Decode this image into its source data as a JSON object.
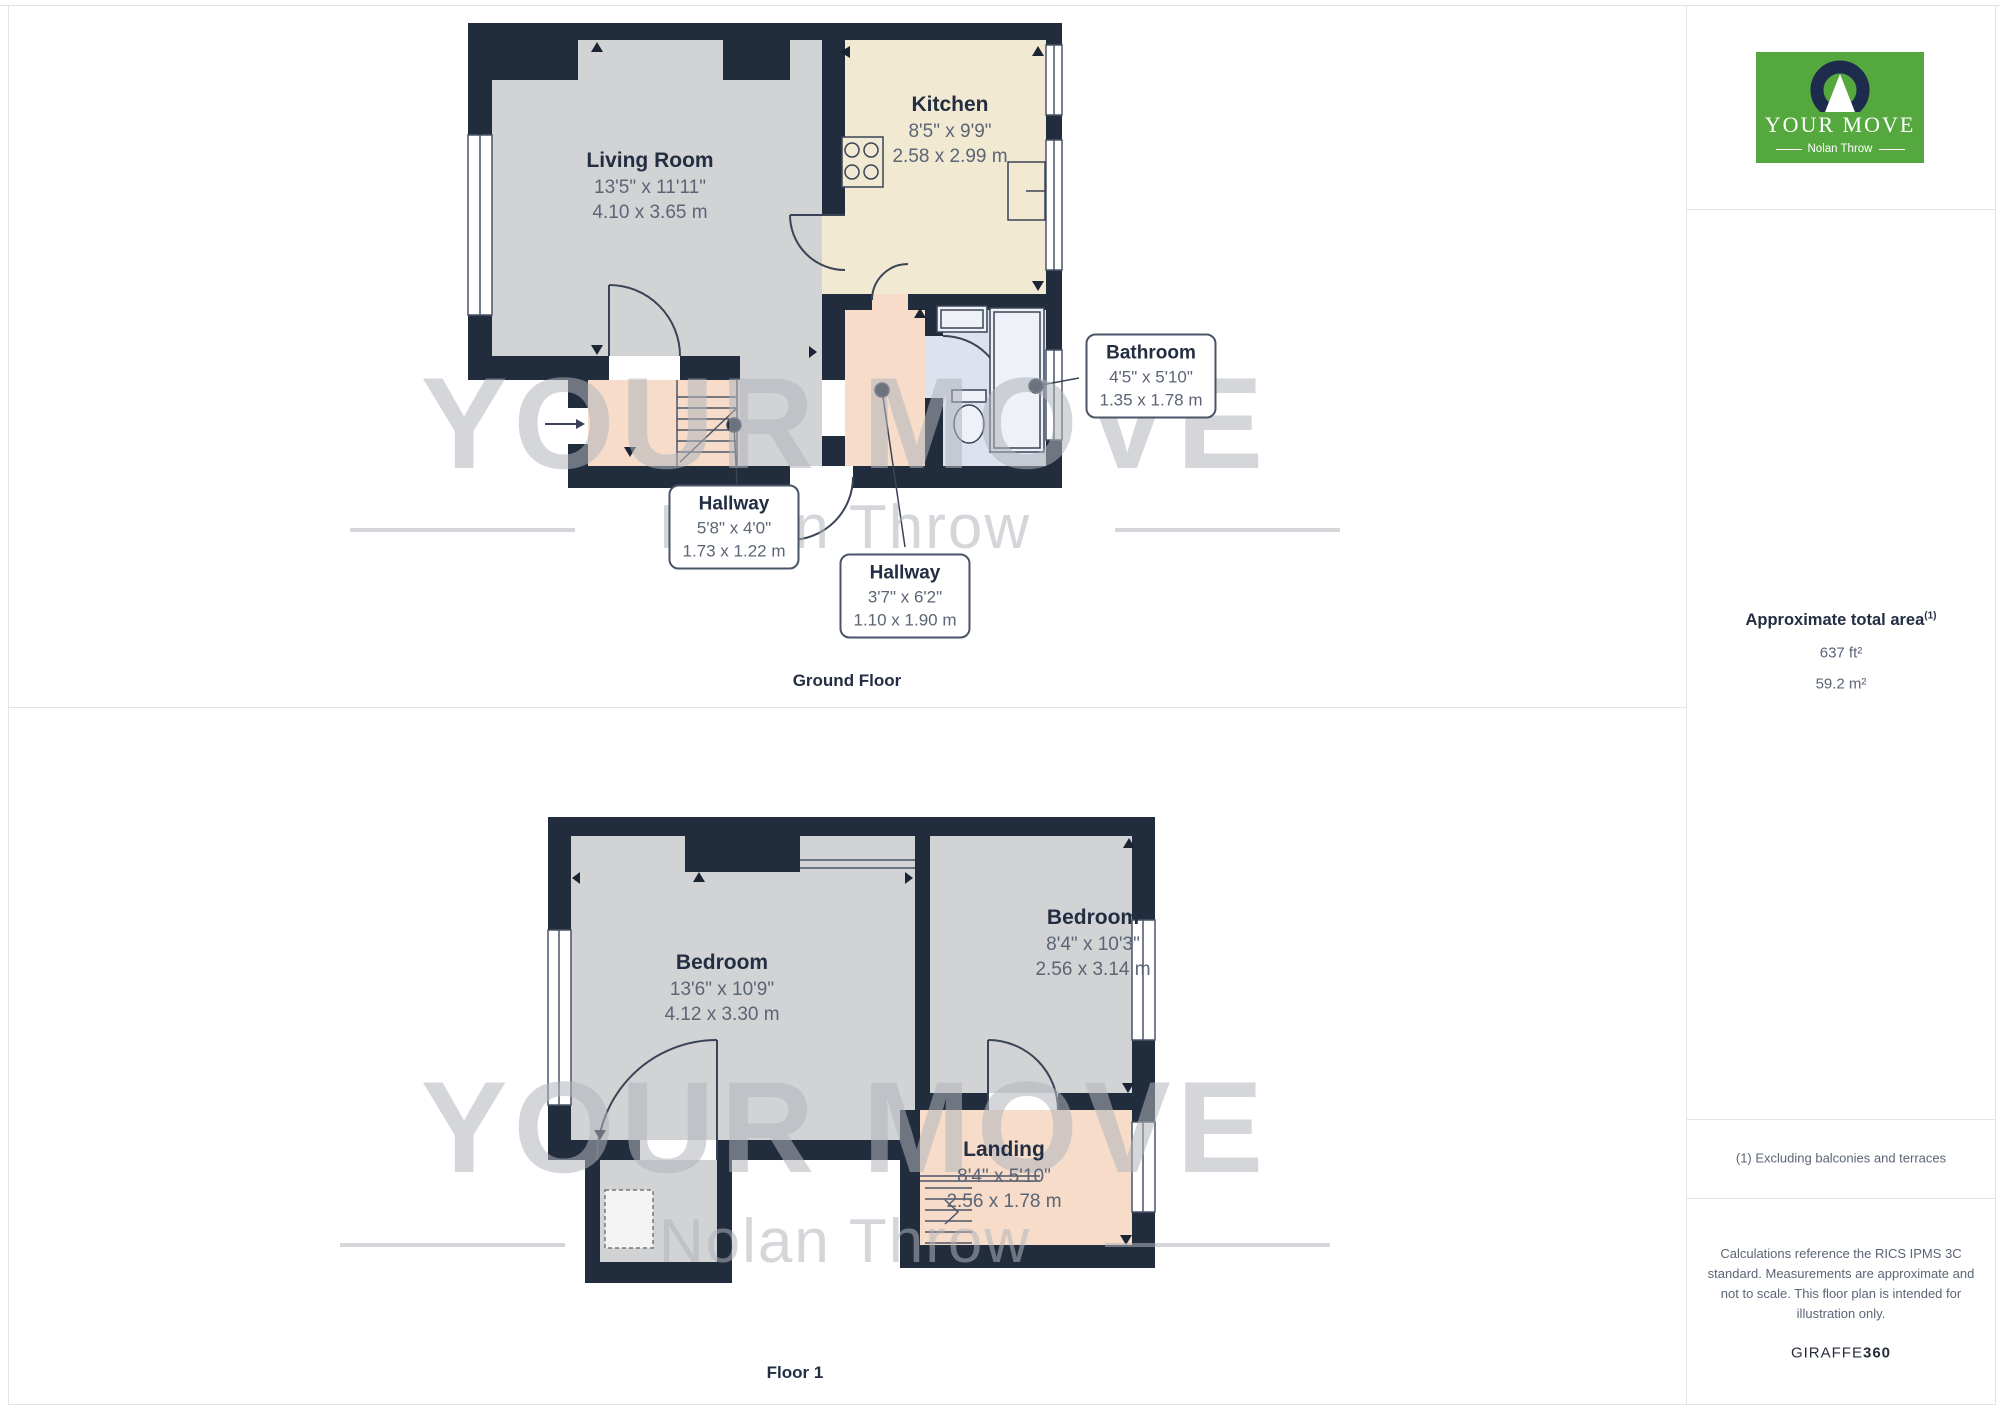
{
  "watermark": {
    "brand": "YOUR MOVE",
    "sub": "Nolan Throw"
  },
  "sidebar": {
    "logo": {
      "brand": "YOUR MOVE",
      "sub": "Nolan Throw"
    },
    "area": {
      "title": "Approximate total area",
      "superscript": "(1)",
      "imperial": "637 ft²",
      "metric": "59.2 m²"
    },
    "footnote": "(1) Excluding balconies and terraces",
    "disclaimer": "Calculations reference the RICS IPMS 3C standard. Measurements are approximate and not to scale. This floor plan is intended for illustration only.",
    "credit": {
      "brand": "GIRAFFE",
      "suffix": "360"
    }
  },
  "ground_floor": {
    "label": "Ground Floor",
    "rooms": {
      "living": {
        "name": "Living Room",
        "imperial": "13'5\" x 11'11\"",
        "metric": "4.10 x 3.65 m"
      },
      "kitchen": {
        "name": "Kitchen",
        "imperial": "8'5\" x 9'9\"",
        "metric": "2.58 x 2.99 m"
      },
      "hallway1": {
        "name": "Hallway",
        "imperial": "5'8\" x 4'0\"",
        "metric": "1.73 x 1.22 m"
      },
      "hallway2": {
        "name": "Hallway",
        "imperial": "3'7\" x 6'2\"",
        "metric": "1.10 x 1.90 m"
      },
      "bathroom": {
        "name": "Bathroom",
        "imperial": "4'5\" x 5'10\"",
        "metric": "1.35 x 1.78 m"
      }
    }
  },
  "floor1": {
    "label": "Floor 1",
    "rooms": {
      "bedroom1": {
        "name": "Bedroom",
        "imperial": "13'6\" x 10'9\"",
        "metric": "4.12 x 3.30 m"
      },
      "bedroom2": {
        "name": "Bedroom",
        "imperial": "8'4\" x 10'3\"",
        "metric": "2.56 x 3.14 m"
      },
      "landing": {
        "name": "Landing",
        "imperial": "8'4\" x 5'10\"",
        "metric": "2.56 x 1.78 m"
      }
    }
  },
  "colors": {
    "brand_green": "#55a83e",
    "logo_navy": "#1d2b4d",
    "wall": "#212c3d",
    "room_gray": "#d2d3d5",
    "kitchen_cream": "#f1e9d2",
    "hallway_pink": "#f6dcc9",
    "bathroom_blue": "#dde2ee",
    "text_navy": "#242e42",
    "text_dim": "#5b6576",
    "watermark_gray": "#b0b4bc"
  }
}
